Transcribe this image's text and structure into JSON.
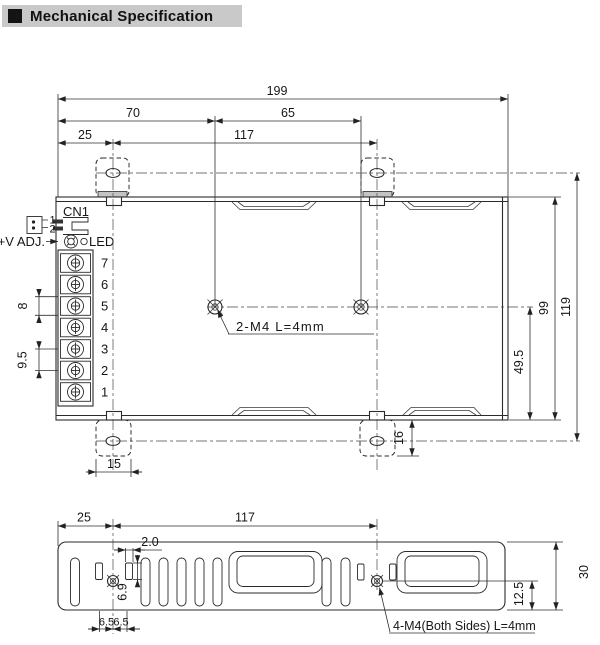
{
  "header": {
    "title": "Mechanical Specification"
  },
  "top_view": {
    "dims": {
      "total_width": "199",
      "hole1_from_left": "70",
      "hole_spacing": "65",
      "flange_hole_from_left": "25",
      "flange_hole_spacing": "117",
      "mounting_height": "119",
      "case_height": "99",
      "hole_to_edge": "49.5",
      "flange_depth": "16",
      "flange_width": "15",
      "terminal_pitch_small": "8",
      "terminal_pitch_large": "9.5"
    },
    "notes": {
      "center_holes": "2-M4 L=4mm"
    },
    "labels": {
      "connector": "CN1",
      "pin1": "1",
      "pin2": "2",
      "vadj": "+V ADJ.",
      "led": "LED"
    },
    "terminals": [
      "7",
      "6",
      "5",
      "4",
      "3",
      "2",
      "1"
    ]
  },
  "side_view": {
    "dims": {
      "flange_hole_from_left": "25",
      "flange_hole_spacing": "117",
      "slot_width": "2.0",
      "slot_height": "6.9",
      "hole_left_offset": "6.5",
      "hole_right_offset": "6.5",
      "case_depth": "30",
      "hole_from_bottom": "12.5"
    },
    "notes": {
      "side_holes": "4-M4(Both Sides) L=4mm"
    }
  }
}
